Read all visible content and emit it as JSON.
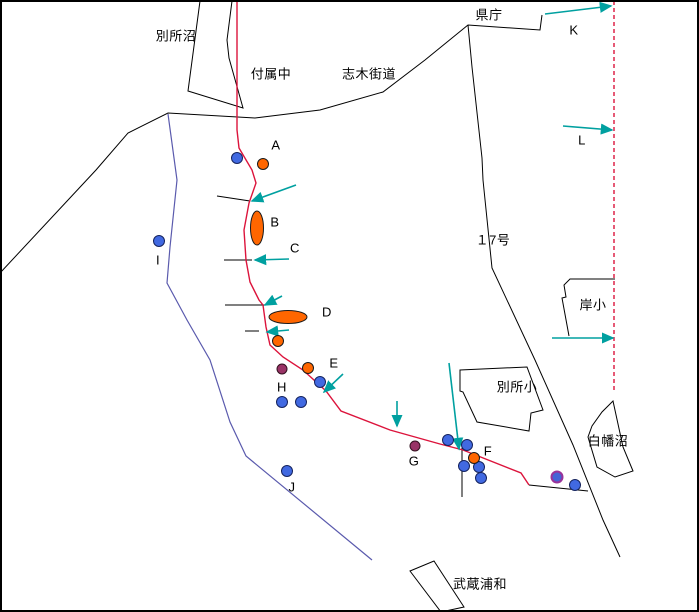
{
  "canvas": {
    "width": 699,
    "height": 612,
    "background": "#ffffff",
    "frame_color": "#000000"
  },
  "colors": {
    "road_black": "#000000",
    "route_red": "#dc143c",
    "boundary_dashed_red": "#dc143c",
    "stream_blue": "#5a5aad",
    "arrow_teal": "#00a0a0",
    "dot_blue": "#4169e1",
    "dot_orange": "#ff6600",
    "dot_purple": "#993366",
    "dot_blue_purple_ring": "#993399"
  },
  "labels": [
    {
      "id": "bessho-numa",
      "text": "別所沼",
      "x": 176,
      "y": 36
    },
    {
      "id": "fuzoku-chu",
      "text": "付属中",
      "x": 271,
      "y": 74
    },
    {
      "id": "shiki-kaido",
      "text": "志木街道",
      "x": 369,
      "y": 74
    },
    {
      "id": "kencho",
      "text": "県庁",
      "x": 489,
      "y": 15
    },
    {
      "id": "route-17",
      "text": "１7号",
      "x": 493,
      "y": 240
    },
    {
      "id": "kishi-sho",
      "text": "岸小",
      "x": 593,
      "y": 305
    },
    {
      "id": "bessho-sho",
      "text": "別所小",
      "x": 517,
      "y": 387
    },
    {
      "id": "shirahata-numa",
      "text": "白幡沼",
      "x": 608,
      "y": 441
    },
    {
      "id": "musashi-urawa",
      "text": "武蔵浦和",
      "x": 480,
      "y": 584
    },
    {
      "id": "point-A",
      "text": "A",
      "x": 276,
      "y": 145
    },
    {
      "id": "point-B",
      "text": "B",
      "x": 275,
      "y": 222
    },
    {
      "id": "point-C",
      "text": "C",
      "x": 295,
      "y": 248
    },
    {
      "id": "point-D",
      "text": "D",
      "x": 327,
      "y": 312
    },
    {
      "id": "point-E",
      "text": "E",
      "x": 334,
      "y": 363
    },
    {
      "id": "point-F",
      "text": "F",
      "x": 488,
      "y": 451
    },
    {
      "id": "point-G",
      "text": "G",
      "x": 414,
      "y": 461
    },
    {
      "id": "point-H",
      "text": "H",
      "x": 282,
      "y": 387
    },
    {
      "id": "point-I",
      "text": "I",
      "x": 158,
      "y": 260
    },
    {
      "id": "point-J",
      "text": "J",
      "x": 292,
      "y": 487
    },
    {
      "id": "point-K",
      "text": "K",
      "x": 574,
      "y": 30
    },
    {
      "id": "point-L",
      "text": "L",
      "x": 582,
      "y": 140
    }
  ],
  "paths": {
    "lake_bessho": "200,1 188,91 243,108 229,58 227,40 232,1",
    "road_main": "0,273 96,170 128,133 168,113 255,118 320,110 383,92 425,60 468,25 540,30 542,15",
    "route17_road": "468,25 472,67 482,158 483,180 492,268 535,360 573,445 603,520 620,557",
    "kishi_building": "615,279 570,279 564,285 566,297 562,298 569,336",
    "bessho_building": "460,370 527,367 543,410 531,413 529,431 477,422 463,392 460,391",
    "station_rect": "410,571 434,561 464,607 441,612",
    "lake_shirahata": "613,401 623,447 633,471 615,477 597,467 588,437 592,426 602,412",
    "line_f_east": "529,485 588,491",
    "vline_f": "462,448 462,497",
    "tick1": "217,196 250,201",
    "tick2": "224,260 252,260",
    "tick3": "225,305 265,305",
    "tick4": "245,331 259,331",
    "red_route": "237,1 237,130 239,148 252,170 256,183 249,203 244,230 246,260 250,282 259,300 263,305 266,327 270,345 283,357 303,370 326,391 341,411 390,430 440,444 463,450 521,473 529,485",
    "red_dashed": "614,1 614,393",
    "blue_stream": "168,114 177,180 170,247 167,283 187,320 210,360 230,422 246,456 372,560"
  },
  "markers": {
    "circles": [
      {
        "type": "blue",
        "x": 237,
        "y": 158,
        "r": 5.5
      },
      {
        "type": "blue",
        "x": 159,
        "y": 241,
        "r": 5.5
      },
      {
        "type": "blue",
        "x": 320,
        "y": 382,
        "r": 5.5
      },
      {
        "type": "blue",
        "x": 282,
        "y": 402,
        "r": 5.5
      },
      {
        "type": "blue",
        "x": 301,
        "y": 402,
        "r": 5.5
      },
      {
        "type": "blue",
        "x": 287,
        "y": 471,
        "r": 5.5
      },
      {
        "type": "blue",
        "x": 448,
        "y": 440,
        "r": 5.5
      },
      {
        "type": "blue",
        "x": 467,
        "y": 445,
        "r": 5.5
      },
      {
        "type": "blue",
        "x": 464,
        "y": 466,
        "r": 5.5
      },
      {
        "type": "blue",
        "x": 479,
        "y": 467,
        "r": 5.5
      },
      {
        "type": "blue",
        "x": 481,
        "y": 478,
        "r": 5.5
      },
      {
        "type": "blue",
        "x": 575,
        "y": 485,
        "r": 5.5
      },
      {
        "type": "orange",
        "x": 263,
        "y": 164,
        "r": 5.5
      },
      {
        "type": "orange",
        "x": 278,
        "y": 341,
        "r": 5.5
      },
      {
        "type": "orange",
        "x": 308,
        "y": 368,
        "r": 5.5
      },
      {
        "type": "orange",
        "x": 474,
        "y": 458,
        "r": 5.5
      },
      {
        "type": "purple",
        "x": 282,
        "y": 369,
        "r": 5
      },
      {
        "type": "purple",
        "x": 415,
        "y": 446,
        "r": 5
      },
      {
        "type": "special",
        "x": 557,
        "y": 477,
        "r": 5.5
      }
    ],
    "ellipses": [
      {
        "id": "ellipse-B",
        "cx": 257,
        "cy": 228,
        "rx": 6.5,
        "ry": 17
      },
      {
        "id": "ellipse-D",
        "cx": 288,
        "cy": 317,
        "rx": 19,
        "ry": 6.5
      }
    ]
  },
  "arrows": [
    {
      "name": "K",
      "x1": 545,
      "y1": 14,
      "x2": 611,
      "y2": 6
    },
    {
      "name": "L",
      "x1": 563,
      "y1": 126,
      "x2": 612,
      "y2": 130
    },
    {
      "name": "kishi-sho",
      "x1": 552,
      "y1": 338,
      "x2": 613,
      "y2": 338
    },
    {
      "name": "route-upper",
      "x1": 296,
      "y1": 185,
      "x2": 252,
      "y2": 201
    },
    {
      "name": "C",
      "x1": 289,
      "y1": 259,
      "x2": 255,
      "y2": 260
    },
    {
      "name": "D",
      "x1": 282,
      "y1": 296,
      "x2": 265,
      "y2": 305
    },
    {
      "name": "route-mid",
      "x1": 289,
      "y1": 330,
      "x2": 267,
      "y2": 332
    },
    {
      "name": "E",
      "x1": 343,
      "y1": 374,
      "x2": 324,
      "y2": 392
    },
    {
      "name": "G",
      "x1": 397,
      "y1": 401,
      "x2": 397,
      "y2": 426
    },
    {
      "name": "F",
      "x1": 449,
      "y1": 363,
      "x2": 459,
      "y2": 449
    }
  ]
}
